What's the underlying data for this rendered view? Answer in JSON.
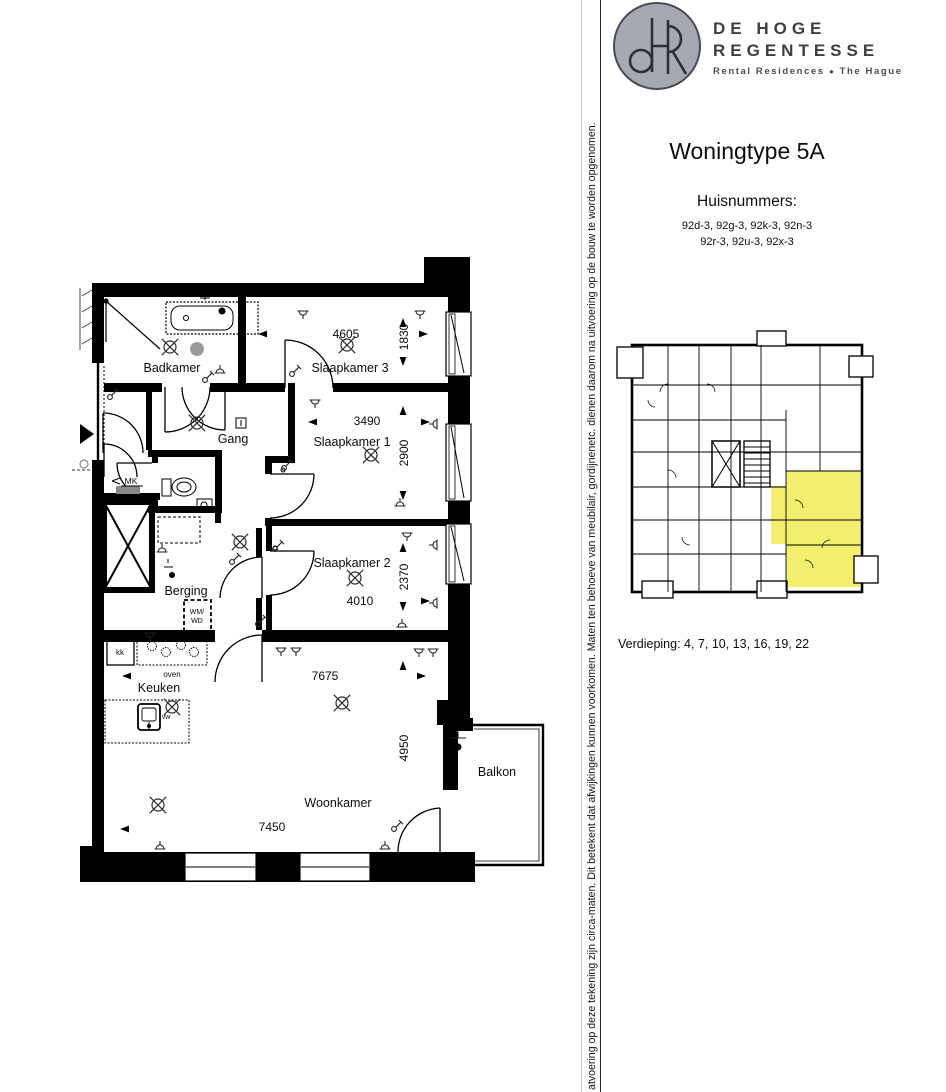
{
  "brand": {
    "monogram": "dR",
    "name_line1": "DE HOGE",
    "name_line2": "REGENTESSE",
    "tagline_left": "Rental Residences",
    "tagline_separator": "●",
    "tagline_right": "The Hague"
  },
  "unit": {
    "title": "Woningtype 5A",
    "huisnummers_label": "Huisnummers:",
    "huisnummers_line1": "92d-3, 92g-3, 92k-3, 92n-3",
    "huisnummers_line2": "92r-3, 92u-3, 92x-3",
    "verdieping_label": "Verdieping: 4, 7, 10, 13, 16, 19, 22"
  },
  "disclaimer_vertical_text": "atvoering op deze tekening zijn circa-maten. Dit betekent dat afwijkingen kunnen voorkomen. Maten ten behoeve van meubilair, gordijnenetc. dienen daarom na uitvoering op de bouw te worden opgenomen.",
  "floorplan": {
    "rooms": {
      "badkamer": "Badkamer",
      "slaapkamer3": "Slaapkamer 3",
      "slaapkamer1": "Slaapkamer 1",
      "slaapkamer2": "Slaapkamer 2",
      "gang": "Gang",
      "berging": "Berging",
      "keuken": "Keuken",
      "woonkamer": "Woonkamer",
      "balkon": "Balkon"
    },
    "dimensions_mm": {
      "slaapkamer3_width": "4605",
      "slaapkamer3_depth": "1830",
      "slaapkamer1_width": "3490",
      "slaapkamer1_depth": "2900",
      "slaapkamer2_width": "4010",
      "slaapkamer2_depth": "2370",
      "woonkamer_width": "7675",
      "woonkamer_depth": "4950",
      "woonkamer_width_lower": "7450"
    },
    "labels": {
      "meterkast": "MK",
      "koelkast": "kk",
      "oven": "oven",
      "vaatwasser": "vw",
      "wasmachine": "WM/",
      "wasdroger": "WD"
    }
  },
  "overview_plan": {
    "highlight_color": "#f2ee6e"
  },
  "colors": {
    "wall": "#000000",
    "logo_circle": "#a5a9b4",
    "highlight": "#f2ee6e"
  }
}
